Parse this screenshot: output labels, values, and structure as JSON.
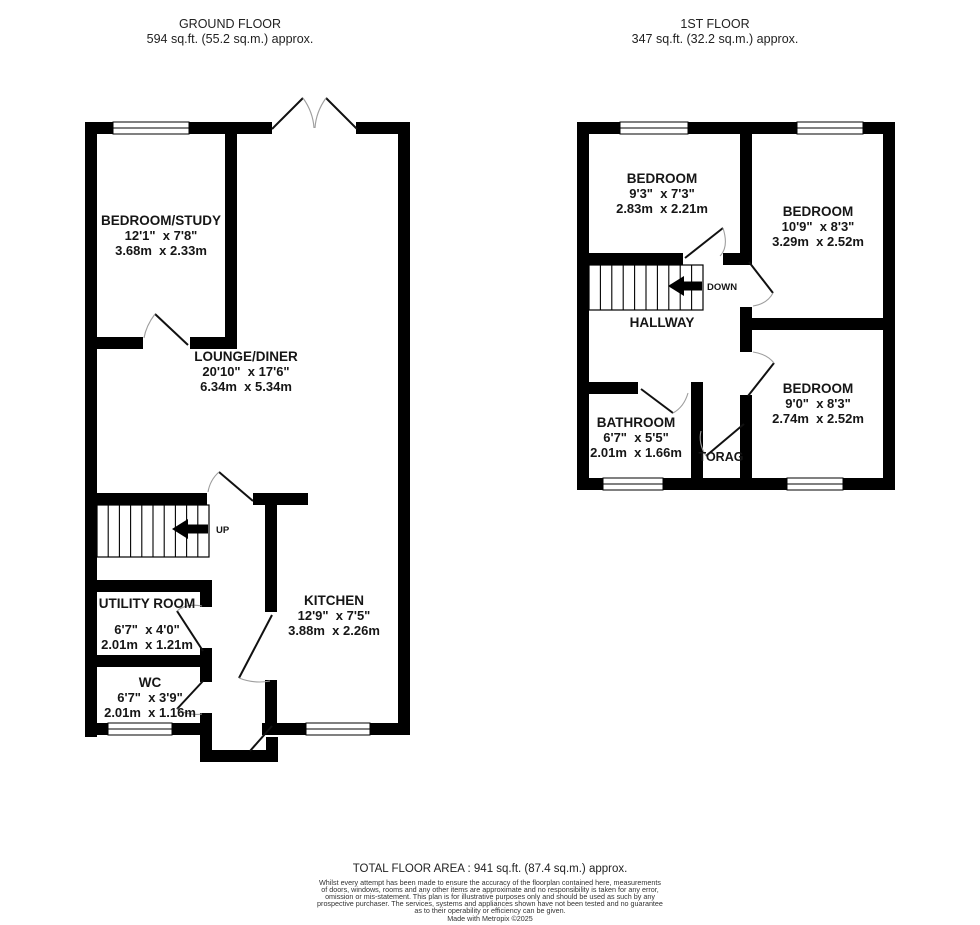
{
  "ground_floor": {
    "title": "GROUND FLOOR",
    "area": "594 sq.ft. (55.2 sq.m.) approx.",
    "stair_label": "UP",
    "rooms": {
      "bedroom_study": {
        "name": "BEDROOM/STUDY",
        "imperial": "12'1\"  x 7'8\"",
        "metric": "3.68m  x 2.33m"
      },
      "lounge_diner": {
        "name": "LOUNGE/DINER",
        "imperial": "20'10\"  x 17'6\"",
        "metric": "6.34m  x 5.34m"
      },
      "kitchen": {
        "name": "KITCHEN",
        "imperial": "12'9\"  x 7'5\"",
        "metric": "3.88m  x 2.26m"
      },
      "utility_room": {
        "name": "UTILITY ROOM",
        "imperial": "6'7\"  x 4'0\"",
        "metric": "2.01m  x 1.21m"
      },
      "wc": {
        "name": "WC",
        "imperial": "6'7\"  x 3'9\"",
        "metric": "2.01m  x 1.16m"
      }
    }
  },
  "first_floor": {
    "title": "1ST FLOOR",
    "area": "347 sq.ft. (32.2 sq.m.) approx.",
    "stair_label": "DOWN",
    "hallway_label": "HALLWAY",
    "storage_label": "TORAG",
    "rooms": {
      "bedroom_front": {
        "name": "BEDROOM",
        "imperial": "9'3\"  x 7'3\"",
        "metric": "2.83m  x 2.21m"
      },
      "bedroom_right": {
        "name": "BEDROOM",
        "imperial": "10'9\"  x 8'3\"",
        "metric": "3.29m  x 2.52m"
      },
      "bedroom_back": {
        "name": "BEDROOM",
        "imperial": "9'0\"  x 8'3\"",
        "metric": "2.74m  x 2.52m"
      },
      "bathroom": {
        "name": "BATHROOM",
        "imperial": "6'7\"  x 5'5\"",
        "metric": "2.01m  x 1.66m"
      }
    }
  },
  "footer": {
    "total_area": "TOTAL FLOOR AREA : 941 sq.ft. (87.4 sq.m.) approx.",
    "disclaimer": "Whilst every attempt has been made to ensure the accuracy of the floorplan contained here, measurements\nof doors, windows, rooms and any other items are approximate and no responsibility is taken for any error,\nomission or mis-statement. This plan is for illustrative purposes only and should be used as such by any\nprospective purchaser. The services, systems and appliances shown have not been tested and no guarantee\nas to their operability or efficiency can be given.",
    "credit": "Made with Metropix ©2025"
  },
  "colors": {
    "wall": "#000000",
    "text": "#1c1c1c",
    "door_arc": "#9e9e9e"
  }
}
